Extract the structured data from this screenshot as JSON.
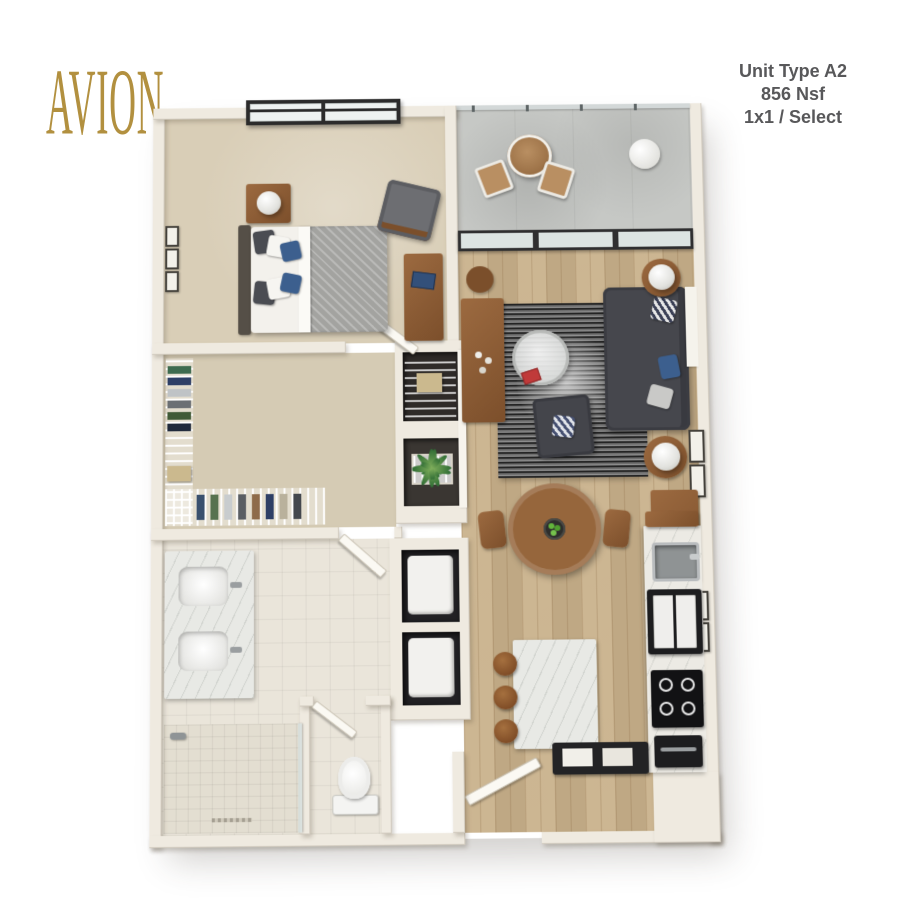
{
  "brand": {
    "logo_text": "AVION",
    "logo_color": "#B2903F"
  },
  "unit_info": {
    "title": "Unit Type A2",
    "area": "856 Nsf",
    "type": "1x1 / Select",
    "text_color": "#58585A"
  },
  "palette": {
    "wall": "#EFEAE0",
    "wall_shadow": "#D8D1C3",
    "wood_floor": "#C9B18B",
    "carpet": "#D9CEB7",
    "bath_tile": "#EAE5DA",
    "balcony_concrete": "#C6C8C5",
    "rug_dark": "#3A3A3A",
    "sofa_gray": "#46474D",
    "furniture_wood": "#8B5B34",
    "marble": "#E8E9E5",
    "appliance_black": "#1D1D1F",
    "plant_green": "#4E8A4A",
    "pillow_blue": "#3C5F8E",
    "window_frame": "#2B2B2B"
  },
  "floor_plan": {
    "rooms": [
      "bedroom",
      "balcony",
      "living-room",
      "dining-area",
      "kitchen",
      "entry",
      "walk-in-closet",
      "hall-closets",
      "bathroom",
      "shower",
      "water-closet",
      "laundry-closet"
    ],
    "elements": [
      "bed",
      "nightstand",
      "table-lamp",
      "bedroom-armchair",
      "desk",
      "bedroom-window",
      "bistro-table",
      "bistro-chairs",
      "balcony-plant",
      "glass-railing",
      "sliding-glass-door",
      "sectional-sofa",
      "area-rug",
      "coffee-table",
      "accent-armchair",
      "side-tables",
      "console-table",
      "dining-table",
      "dining-chairs",
      "sideboard",
      "kitchen-island",
      "bar-stools",
      "sink",
      "refrigerator",
      "cooktop",
      "dishwasher",
      "entry-console",
      "entry-door",
      "double-vanity",
      "walk-in-shower",
      "toilet",
      "stacked-washer-dryer",
      "wire-shelving",
      "wall-art"
    ]
  }
}
